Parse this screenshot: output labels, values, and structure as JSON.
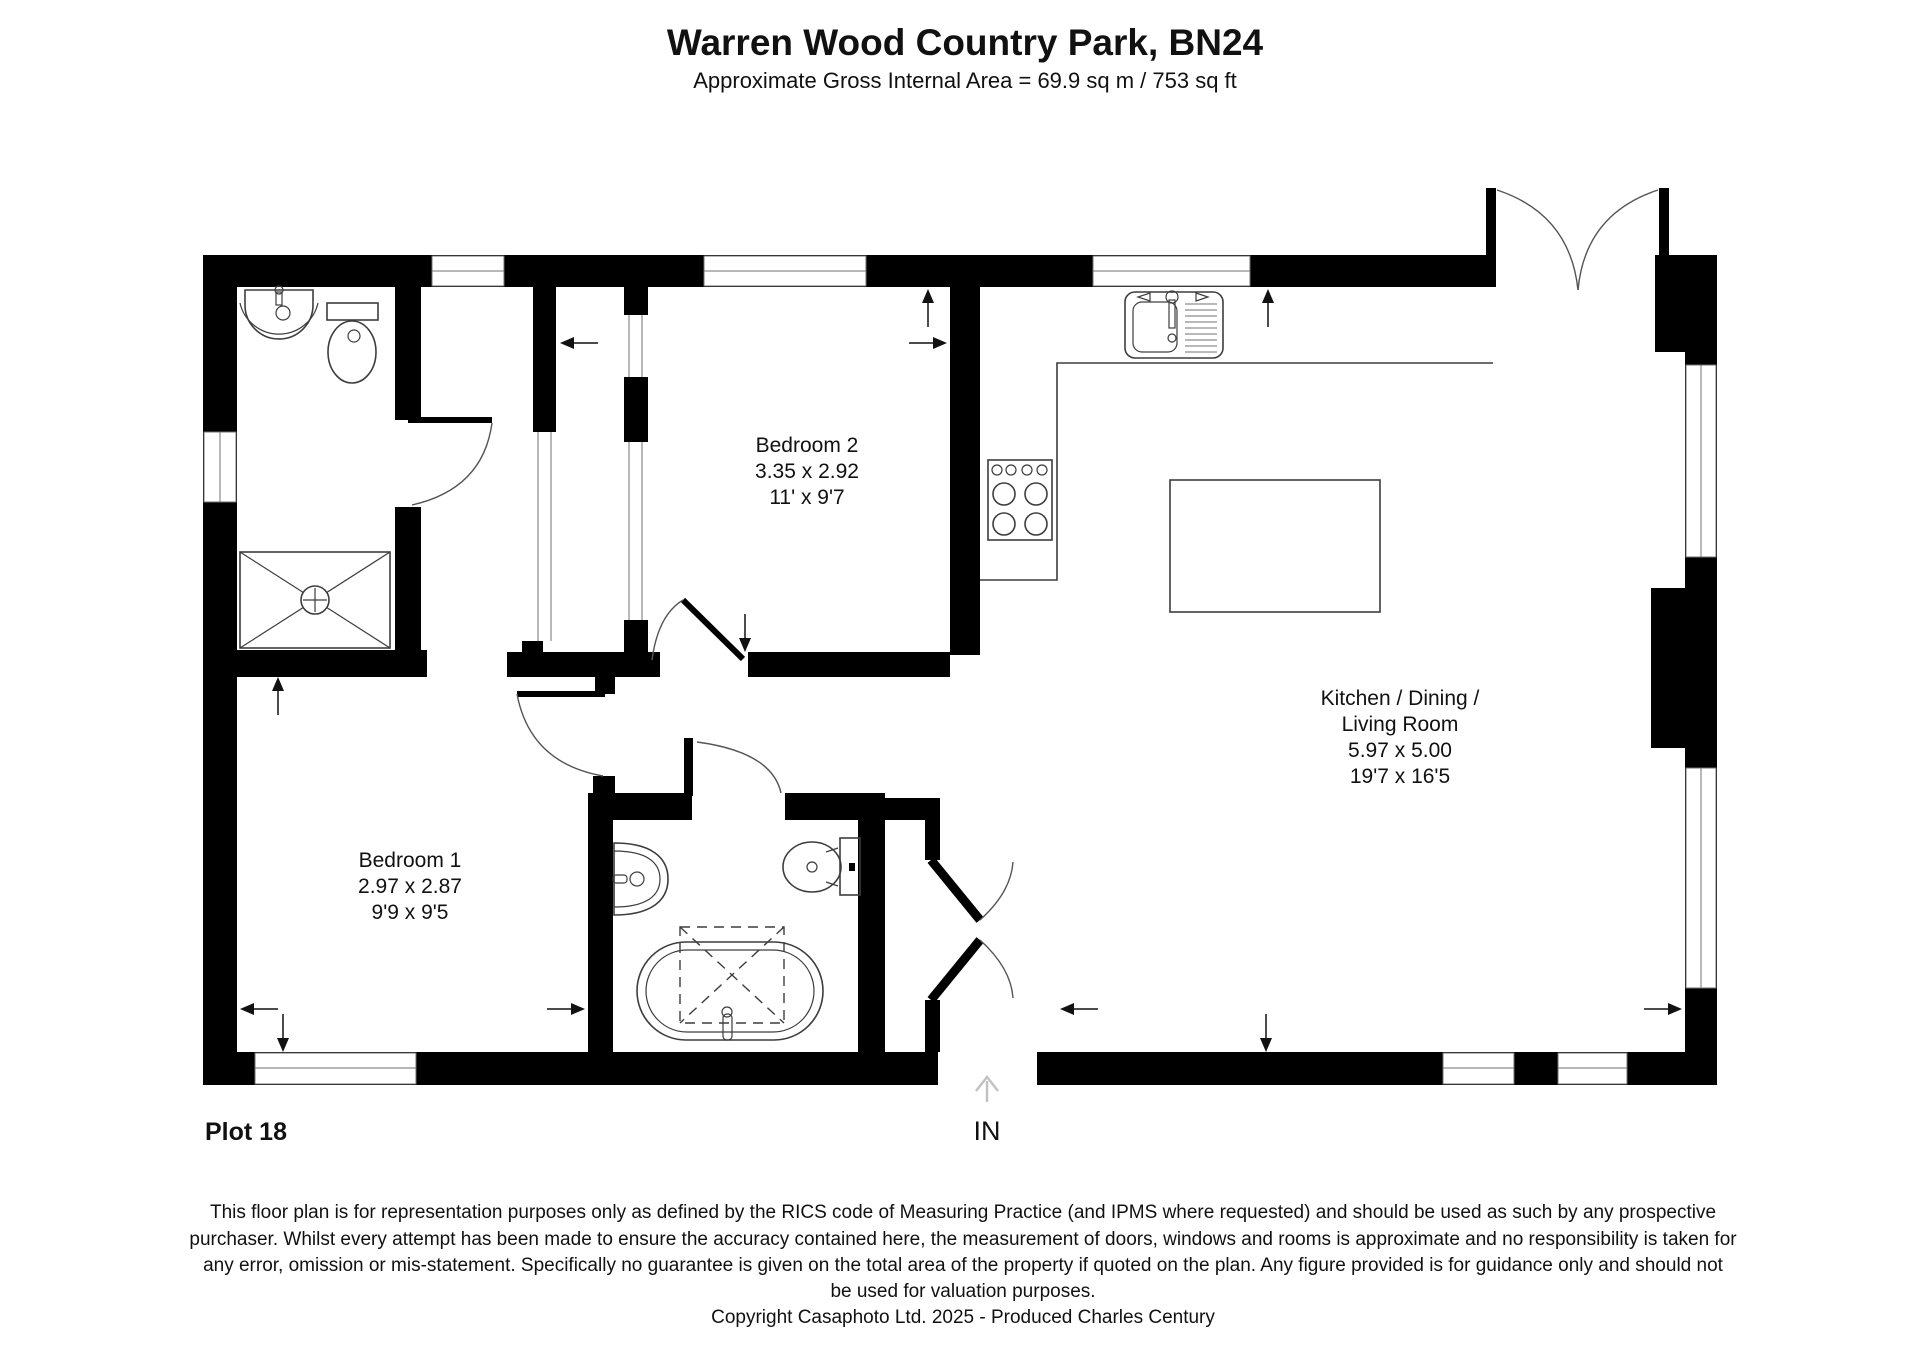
{
  "header": {
    "title": "Warren Wood Country Park, BN24",
    "subtitle": "Approximate Gross Internal Area = 69.9 sq m / 753 sq ft"
  },
  "plan": {
    "plot_label": "Plot 18",
    "entrance": {
      "label": "IN"
    },
    "rooms": {
      "bedroom2": {
        "name": "Bedroom 2",
        "metric": "3.35 x 2.92",
        "imperial": "11' x 9'7"
      },
      "bedroom1": {
        "name": "Bedroom 1",
        "metric": "2.97 x 2.87",
        "imperial": "9'9 x 9'5"
      },
      "kitchen": {
        "name_line1": "Kitchen / Dining /",
        "name_line2": "Living Room",
        "metric": "5.97 x 5.00",
        "imperial": "19'7 x 16'5"
      }
    }
  },
  "footer": {
    "disclaimer_lines": [
      "This floor plan is for representation purposes only as defined by the RICS code of Measuring Practice (and IPMS where requested) and should be used as such by any prospective",
      "purchaser. Whilst every attempt has been made to ensure the accuracy contained here, the measurement of doors, windows and rooms is approximate and no responsibility is taken for",
      "any error, omission or mis-statement. Specifically no guarantee is given on the total area of the property if quoted on the plan. Any figure provided is for guidance only and should not",
      "be used for valuation purposes."
    ],
    "copyright": "Copyright Casaphoto Ltd. 2025 - Produced Charles Century"
  },
  "colors": {
    "wall": "#000000",
    "line": "#3d3d3d",
    "window_line": "#707070",
    "in_arrow": "#c2c2c2"
  }
}
